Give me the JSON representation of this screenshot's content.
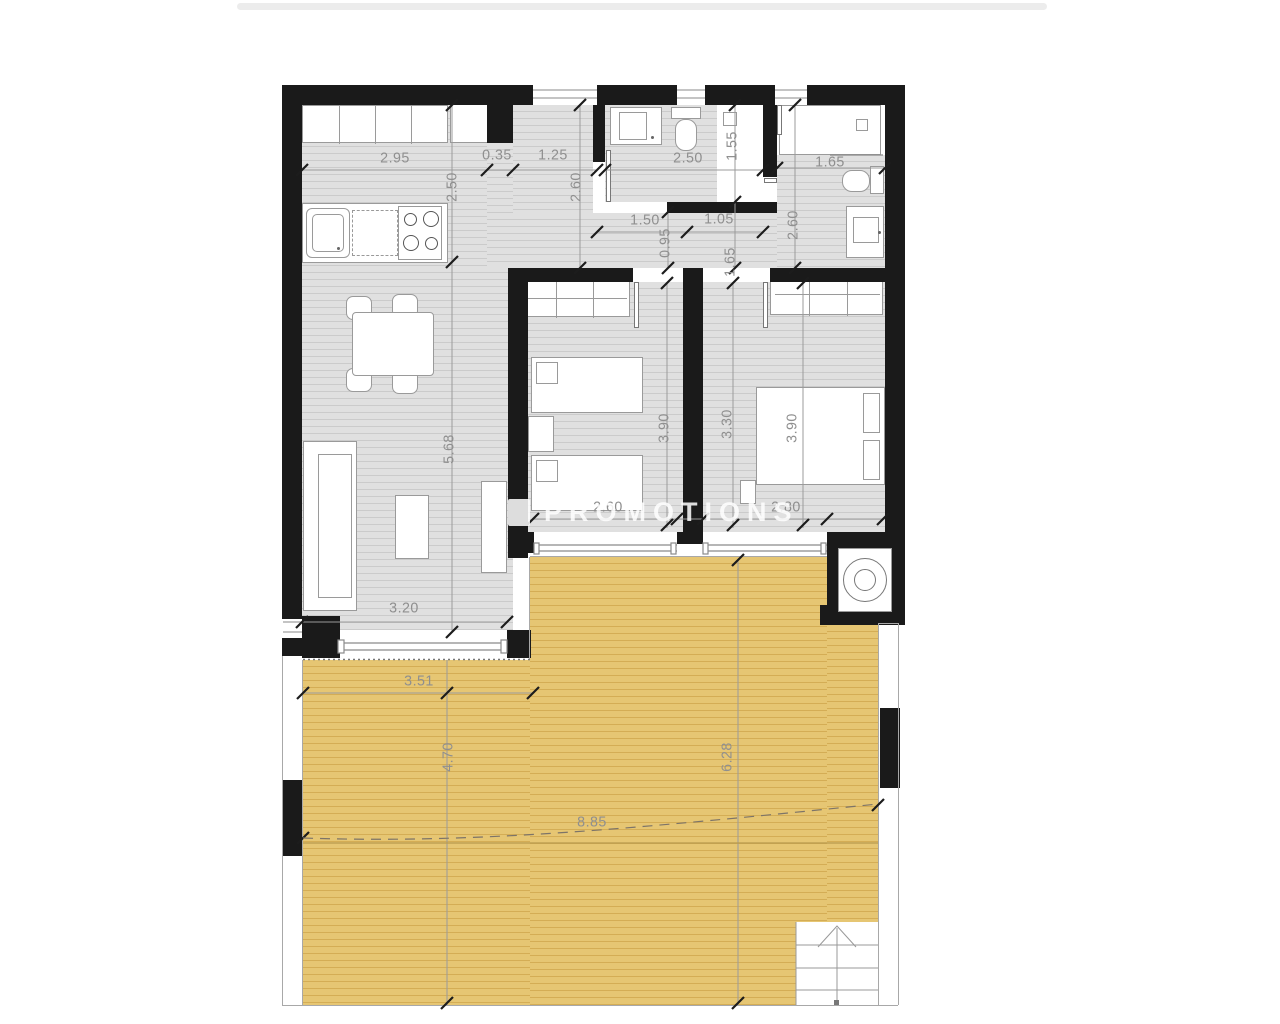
{
  "palette": {
    "wall": "#1a1a1a",
    "floor": "#e0e0e0",
    "floor_line": "#cbcbcb",
    "terrace": "#e6c673",
    "terrace_line": "#d4ad55",
    "dim_text": "#8f8f8f",
    "top_bar": "#ececec"
  },
  "watermark": {
    "text": "PROMOTIONS"
  },
  "plan": {
    "dimension_labels": [
      {
        "text": "2.95",
        "x": 395,
        "y": 158,
        "rot": 0
      },
      {
        "text": "0.35",
        "x": 497,
        "y": 155,
        "rot": 0
      },
      {
        "text": "1.25",
        "x": 553,
        "y": 155,
        "rot": 0
      },
      {
        "text": "2.50",
        "x": 688,
        "y": 158,
        "rot": 0
      },
      {
        "text": "1.65",
        "x": 830,
        "y": 162,
        "rot": 0
      },
      {
        "text": "1.50",
        "x": 645,
        "y": 220,
        "rot": 0
      },
      {
        "text": "1.05",
        "x": 719,
        "y": 219,
        "rot": 0
      },
      {
        "text": "2.50",
        "x": 452,
        "y": 187,
        "rot": 1
      },
      {
        "text": "2.60",
        "x": 576,
        "y": 187,
        "rot": 1
      },
      {
        "text": "1.55",
        "x": 732,
        "y": 146,
        "rot": 1
      },
      {
        "text": "0.95",
        "x": 665,
        "y": 243,
        "rot": 1
      },
      {
        "text": "1.65",
        "x": 730,
        "y": 262,
        "rot": 1
      },
      {
        "text": "2.60",
        "x": 793,
        "y": 225,
        "rot": 1
      },
      {
        "text": "5.68",
        "x": 449,
        "y": 449,
        "rot": 1
      },
      {
        "text": "3.90",
        "x": 664,
        "y": 428,
        "rot": 1
      },
      {
        "text": "3.30",
        "x": 727,
        "y": 424,
        "rot": 1
      },
      {
        "text": "3.90",
        "x": 792,
        "y": 428,
        "rot": 1
      },
      {
        "text": "2.60",
        "x": 608,
        "y": 507,
        "rot": 0
      },
      {
        "text": "2.80",
        "x": 786,
        "y": 507,
        "rot": 0
      },
      {
        "text": "3.20",
        "x": 404,
        "y": 608,
        "rot": 0
      },
      {
        "text": "3.51",
        "x": 419,
        "y": 681,
        "rot": 0
      },
      {
        "text": "4.70",
        "x": 448,
        "y": 757,
        "rot": 1
      },
      {
        "text": "6.28",
        "x": 727,
        "y": 757,
        "rot": 1
      },
      {
        "text": "8.85",
        "x": 592,
        "y": 822,
        "rot": 0
      }
    ],
    "dim_lines": [
      [
        302,
        170,
        597,
        170
      ],
      [
        605,
        170,
        763,
        170
      ],
      [
        777,
        168,
        885,
        168
      ],
      [
        597,
        232,
        763,
        232
      ],
      [
        533,
        519,
        883,
        519
      ],
      [
        302,
        622,
        507,
        622
      ],
      [
        303,
        693,
        533,
        693
      ],
      [
        452,
        105,
        452,
        632
      ],
      [
        580,
        105,
        580,
        268
      ],
      [
        735,
        105,
        735,
        268
      ],
      [
        668,
        212,
        668,
        268
      ],
      [
        795,
        105,
        795,
        268
      ],
      [
        667,
        283,
        667,
        528
      ],
      [
        733,
        283,
        733,
        528
      ],
      [
        803,
        283,
        803,
        528
      ],
      [
        447,
        660,
        447,
        1005
      ],
      [
        738,
        560,
        738,
        1005
      ]
    ],
    "ticks": [
      [
        302,
        170
      ],
      [
        487,
        170
      ],
      [
        513,
        170
      ],
      [
        597,
        170
      ],
      [
        605,
        170
      ],
      [
        763,
        170
      ],
      [
        777,
        168
      ],
      [
        885,
        168
      ],
      [
        597,
        232
      ],
      [
        687,
        232
      ],
      [
        763,
        232
      ],
      [
        533,
        519
      ],
      [
        677,
        519
      ],
      [
        703,
        519
      ],
      [
        827,
        519
      ],
      [
        883,
        519
      ],
      [
        302,
        622
      ],
      [
        507,
        622
      ],
      [
        303,
        693
      ],
      [
        533,
        693
      ],
      [
        452,
        105
      ],
      [
        452,
        262
      ],
      [
        452,
        632
      ],
      [
        580,
        105
      ],
      [
        580,
        268
      ],
      [
        735,
        105
      ],
      [
        735,
        202
      ],
      [
        735,
        268
      ],
      [
        668,
        212
      ],
      [
        668,
        268
      ],
      [
        795,
        105
      ],
      [
        795,
        268
      ],
      [
        667,
        283
      ],
      [
        667,
        525
      ],
      [
        733,
        283
      ],
      [
        733,
        525
      ],
      [
        803,
        283
      ],
      [
        803,
        525
      ],
      [
        447,
        693
      ],
      [
        447,
        1003
      ],
      [
        738,
        560
      ],
      [
        738,
        1003
      ],
      [
        303,
        838
      ],
      [
        878,
        805
      ]
    ],
    "dashed_measure": {
      "path": "M303,838 C480,844 640,828 878,804"
    },
    "level_line": [
      303,
      843,
      878,
      843
    ]
  }
}
